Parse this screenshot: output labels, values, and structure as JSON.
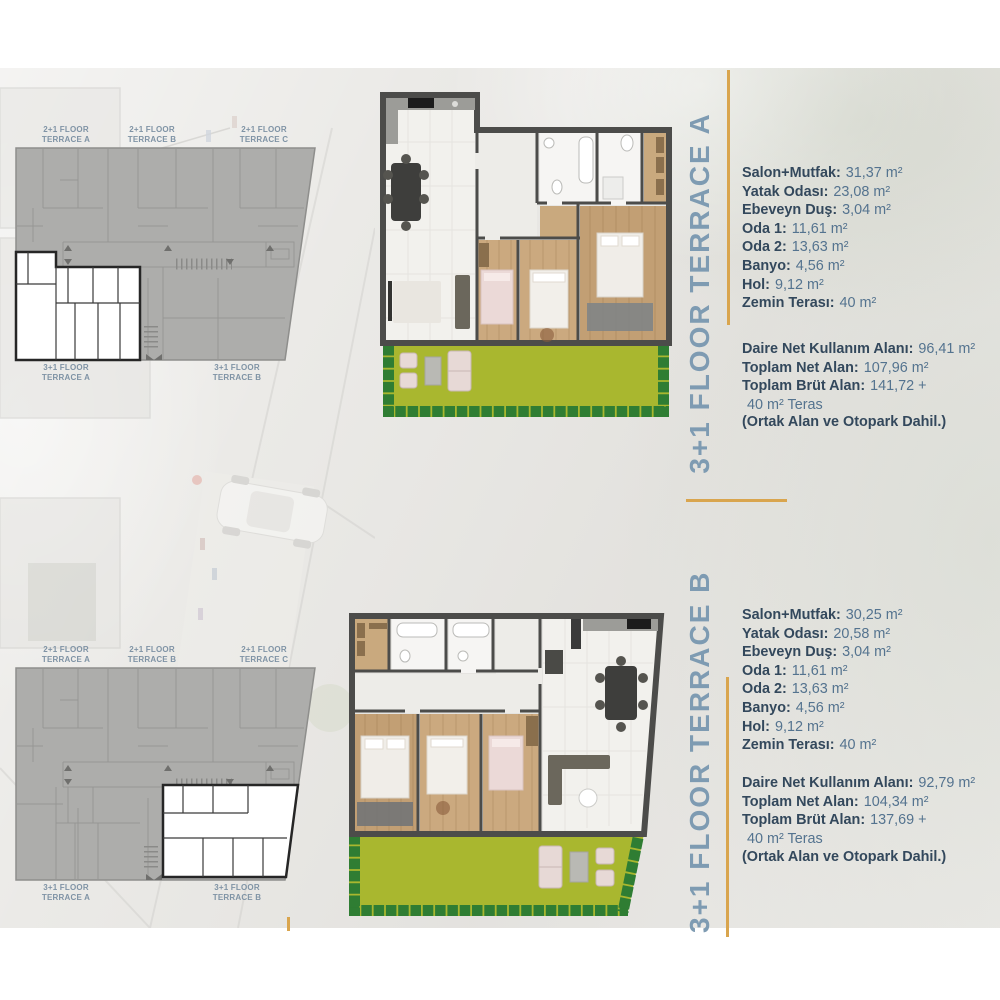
{
  "keyplan": {
    "top_labels": [
      {
        "l1": "2+1 FLOOR",
        "l2": "TERRACE A"
      },
      {
        "l1": "2+1 FLOOR",
        "l2": "TERRACE B"
      },
      {
        "l1": "2+1 FLOOR",
        "l2": "TERRACE C"
      }
    ],
    "bottom_labels": [
      {
        "l1": "3+1 FLOOR",
        "l2": "TERRACE A"
      },
      {
        "l1": "3+1 FLOOR",
        "l2": "TERRACE B"
      }
    ]
  },
  "sections": [
    {
      "vertical_label": "3+1 FLOOR TERRACE A",
      "stats": [
        {
          "label": "Salon+Mutfak:",
          "value": "31,37 m²"
        },
        {
          "label": "Yatak Odası:",
          "value": "23,08 m²"
        },
        {
          "label": "Ebeveyn Duş:",
          "value": "3,04 m²"
        },
        {
          "label": "Oda 1:",
          "value": "11,61 m²"
        },
        {
          "label": "Oda 2:",
          "value": "13,63 m²"
        },
        {
          "label": "Banyo:",
          "value": "4,56 m²"
        },
        {
          "label": "Hol:",
          "value": "9,12 m²"
        },
        {
          "label": "Zemin Terası:",
          "value": "40 m²"
        }
      ],
      "totals": [
        {
          "label": "Daire Net Kullanım Alanı:",
          "value": "96,41 m²"
        },
        {
          "label": "Toplam Net Alan:",
          "value": "107,96 m²"
        },
        {
          "label": "Toplam Brüt Alan:",
          "value": "141,72 +"
        },
        {
          "label": "",
          "value": "40 m² Teras"
        }
      ],
      "note": "(Ortak Alan ve Otopark Dahil.)"
    },
    {
      "vertical_label": "3+1 FLOOR TERRACE B",
      "stats": [
        {
          "label": "Salon+Mutfak:",
          "value": "30,25 m²"
        },
        {
          "label": "Yatak Odası:",
          "value": "20,58 m²"
        },
        {
          "label": "Ebeveyn Duş:",
          "value": "3,04 m²"
        },
        {
          "label": "Oda 1:",
          "value": "11,61 m²"
        },
        {
          "label": "Oda 2:",
          "value": "13,63 m²"
        },
        {
          "label": "Banyo:",
          "value": "4,56 m²"
        },
        {
          "label": "Hol:",
          "value": "9,12 m²"
        },
        {
          "label": "Zemin Terası:",
          "value": "40 m²"
        }
      ],
      "totals": [
        {
          "label": "Daire Net Kullanım Alanı:",
          "value": "92,79 m²"
        },
        {
          "label": "Toplam Net Alan:",
          "value": "104,34 m²"
        },
        {
          "label": "Toplam Brüt Alan:",
          "value": "137,69 +"
        },
        {
          "label": "",
          "value": "40 m² Teras"
        }
      ],
      "note": "(Ortak Alan ve Otopark Dahil.)"
    }
  ],
  "colors": {
    "gold": "#D9A54E",
    "heading_blue": "#7E9BB2",
    "label_navy": "#33485C",
    "value_blue": "#54738F",
    "garden_green": "#A9B72F",
    "hedge_green": "#2F7D33"
  }
}
